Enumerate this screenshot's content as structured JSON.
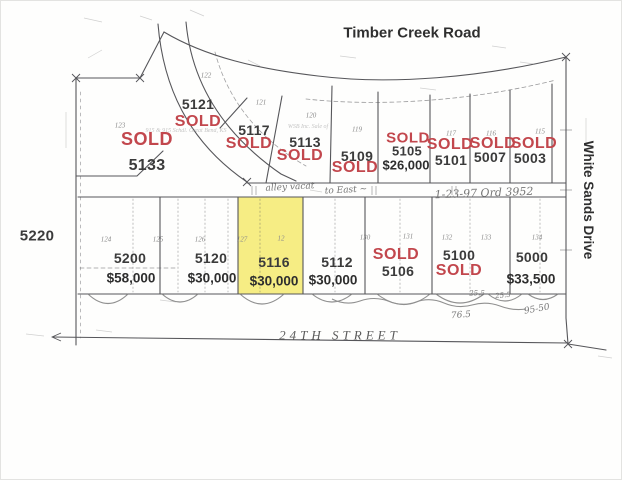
{
  "canvas": {
    "width": 622,
    "height": 480
  },
  "streets": {
    "top_road": "Timber Creek Road",
    "right_road": "White Sands Drive",
    "bottom_road": "24TH STREET"
  },
  "adjacent_parcel": "5220",
  "colors": {
    "sold_red": "#c2474d",
    "highlight_yellow": "#f3e862",
    "line_gray": "#56565a",
    "handwriting_gray": "#777777"
  },
  "top_row_lots": [
    {
      "address": "5133",
      "status": "SOLD"
    },
    {
      "address": "5121",
      "status": "SOLD"
    },
    {
      "address": "5117",
      "status": "SOLD"
    },
    {
      "address": "5113",
      "status": "SOLD"
    },
    {
      "address": "5109",
      "status": "SOLD"
    },
    {
      "address": "5105",
      "status": "SOLD",
      "price": "$26,000"
    },
    {
      "address": "5101",
      "status": "SOLD"
    },
    {
      "address": "5007",
      "status": "SOLD"
    },
    {
      "address": "5003",
      "status": "SOLD"
    }
  ],
  "bottom_row_lots": [
    {
      "address": "5200",
      "price": "$58,000"
    },
    {
      "address": "5120",
      "price": "$30,000"
    },
    {
      "address": "5116",
      "price": "$30,000",
      "highlighted": true
    },
    {
      "address": "5112",
      "price": "$30,000"
    },
    {
      "address": "5106",
      "status": "SOLD"
    },
    {
      "address": "5100",
      "status": "SOLD"
    },
    {
      "address": "5000",
      "price": "$33,500"
    }
  ],
  "plat_numbers": [
    "122",
    "121",
    "120",
    "119",
    "117",
    "116",
    "115",
    "123",
    "124",
    "125",
    "126",
    "127",
    "12",
    "130",
    "131",
    "132",
    "133",
    "134"
  ],
  "handwritten": {
    "alley_note": "alley vacat",
    "alley_note_2": "to East ~",
    "ordinance_note": "1-23-97  Ord 3952",
    "dim_25_a": "25.5",
    "dim_25_b": "25.5",
    "dim_76": "76.5",
    "dim_95": "95-50"
  },
  "fine_print": {
    "note_5121": "915 & 915 Schdl. Great Bend, KS",
    "note_5113": "WSB Inc. Sale of"
  }
}
